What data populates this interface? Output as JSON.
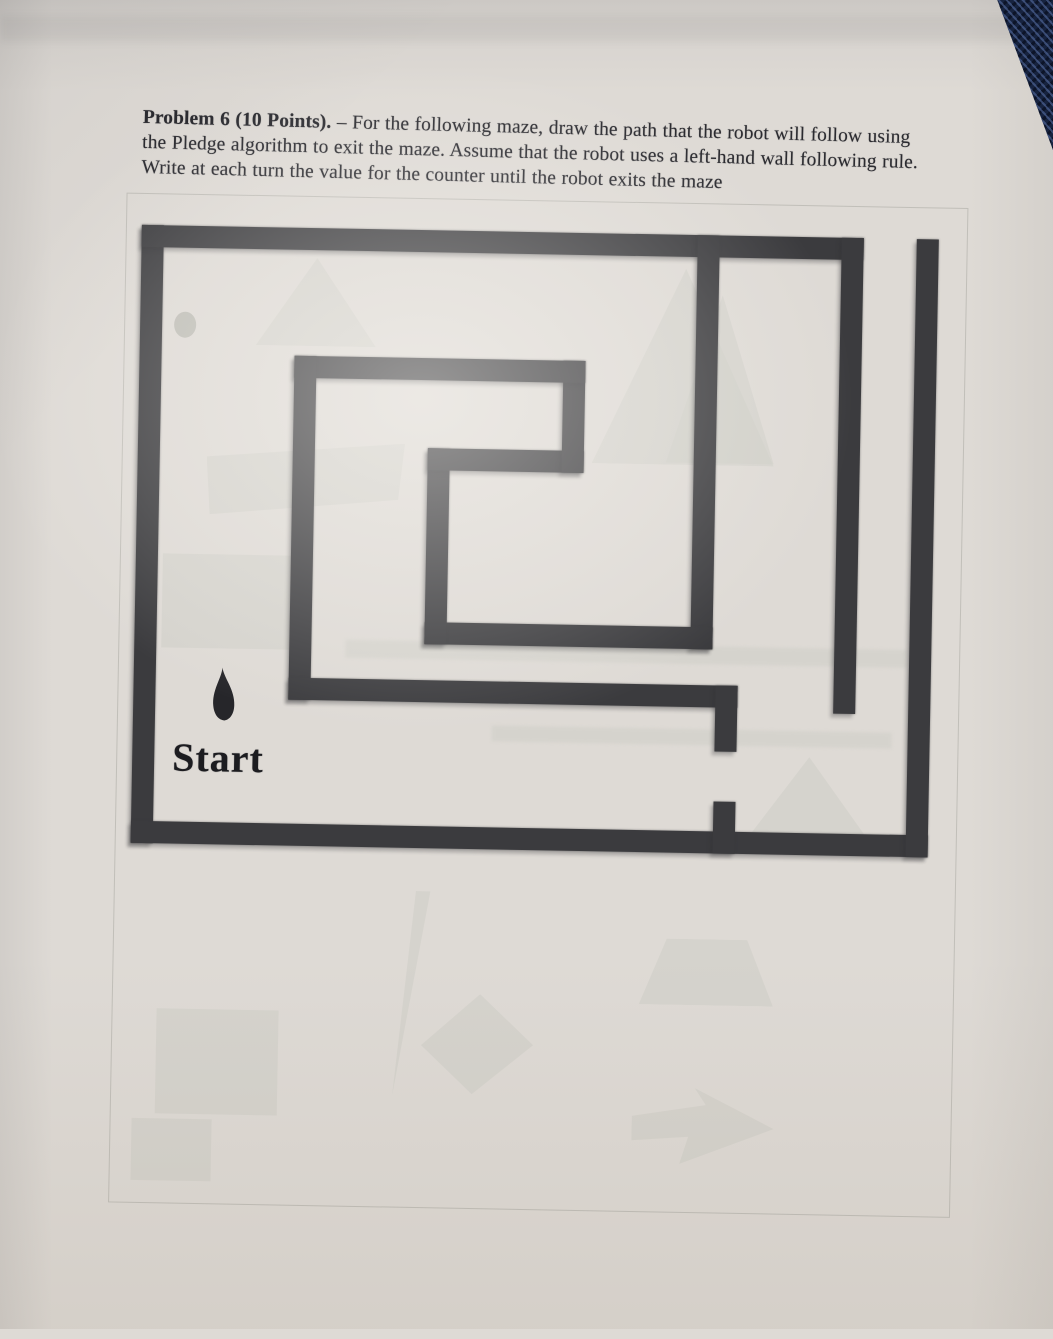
{
  "document": {
    "problem_label": "Problem 6 (10 Points).",
    "problem_text_line1": " – For the following maze, draw the path that the robot will follow using",
    "problem_text_line2": "the Pledge algorithm to exit the maze. Assume that the robot uses a left-hand wall following rule.",
    "problem_text_line3": "Write at each turn the value for the counter until the robot exits the maze",
    "start_label": "Start"
  },
  "colors": {
    "paper": "#dedad5",
    "wall": "#3b3b3e",
    "ink": "#2b2b30",
    "robot": "#26262a",
    "denim": "#17233f",
    "ghost": "#cdcdc6"
  },
  "maze": {
    "origin": {
      "x": 134,
      "y": 232
    },
    "size": {
      "w": 797,
      "h": 618
    },
    "wall_thickness": 22,
    "exit_gap_top": {
      "x1": 722,
      "x2": 775
    },
    "gate_gap_right": {
      "y1": 516,
      "y2": 566
    },
    "walls": [
      {
        "name": "outer-left-wall",
        "x": 0,
        "y": 0,
        "w": 22,
        "h": 618
      },
      {
        "name": "outer-top-wall",
        "x": 0,
        "y": 0,
        "w": 722,
        "h": 22
      },
      {
        "name": "outer-bottom-wall",
        "x": 0,
        "y": 596,
        "w": 797,
        "h": 22
      },
      {
        "name": "outer-right-wall",
        "x": 775,
        "y": 0,
        "w": 22,
        "h": 618
      },
      {
        "name": "inner-vertical-wall-right",
        "x": 700,
        "y": 0,
        "w": 22,
        "h": 476
      },
      {
        "name": "inner-vertical-wall-center",
        "x": 556,
        "y": 0,
        "w": 22,
        "h": 414
      },
      {
        "name": "spiral-inner-bottom-wall",
        "x": 290,
        "y": 392,
        "w": 288,
        "h": 22
      },
      {
        "name": "spiral-inner-left-wall",
        "x": 290,
        "y": 218,
        "w": 22,
        "h": 196
      },
      {
        "name": "spiral-middle-wall",
        "x": 290,
        "y": 218,
        "w": 156,
        "h": 22
      },
      {
        "name": "spiral-inner-right-wall",
        "x": 424,
        "y": 128,
        "w": 22,
        "h": 112
      },
      {
        "name": "spiral-top-wall",
        "x": 155,
        "y": 128,
        "w": 291,
        "h": 22
      },
      {
        "name": "spiral-outer-left-wall",
        "x": 155,
        "y": 128,
        "w": 22,
        "h": 344
      },
      {
        "name": "spiral-outer-bottom-wall",
        "x": 155,
        "y": 450,
        "w": 449,
        "h": 22
      },
      {
        "name": "gate-stub-upper",
        "x": 582,
        "y": 450,
        "w": 22,
        "h": 66
      },
      {
        "name": "gate-stub-lower",
        "x": 582,
        "y": 566,
        "w": 22,
        "h": 52
      }
    ],
    "robot": {
      "x": 76,
      "y": 440,
      "w": 28,
      "h": 56
    },
    "start_label_pos": {
      "x": 40,
      "y": 508
    }
  },
  "ghosts": [
    {
      "kind": "outline",
      "x": 118,
      "y": 200,
      "w": 840,
      "h": 1008
    },
    {
      "kind": "triangle",
      "x": 250,
      "y": 262,
      "w": 120,
      "h": 88
    },
    {
      "kind": "circle",
      "x": 168,
      "y": 318,
      "w": 22,
      "h": 26,
      "dark": true
    },
    {
      "kind": "triangle",
      "x": 588,
      "y": 266,
      "w": 182,
      "h": 196
    },
    {
      "kind": "triangle",
      "x": 662,
      "y": 292,
      "w": 108,
      "h": 168
    },
    {
      "kind": "quad",
      "x": 203,
      "y": 446,
      "w": 198,
      "h": 74
    },
    {
      "kind": "rect",
      "x": 161,
      "y": 560,
      "w": 147,
      "h": 94
    },
    {
      "kind": "bar",
      "x": 345,
      "y": 643,
      "w": 562,
      "h": 18
    },
    {
      "kind": "bar",
      "x": 493,
      "y": 726,
      "w": 400,
      "h": 16
    },
    {
      "kind": "triangle",
      "x": 752,
      "y": 752,
      "w": 118,
      "h": 80
    },
    {
      "kind": "trapezoid",
      "x": 645,
      "y": 936,
      "w": 134,
      "h": 66
    },
    {
      "kind": "needle",
      "x": 400,
      "y": 893,
      "w": 48,
      "h": 205
    },
    {
      "kind": "diamond",
      "x": 428,
      "y": 995,
      "w": 112,
      "h": 100
    },
    {
      "kind": "rect",
      "x": 163,
      "y": 1015,
      "w": 122,
      "h": 105
    },
    {
      "kind": "rect",
      "x": 140,
      "y": 1125,
      "w": 80,
      "h": 62
    },
    {
      "kind": "arrow",
      "x": 640,
      "y": 1085,
      "w": 142,
      "h": 76
    }
  ]
}
